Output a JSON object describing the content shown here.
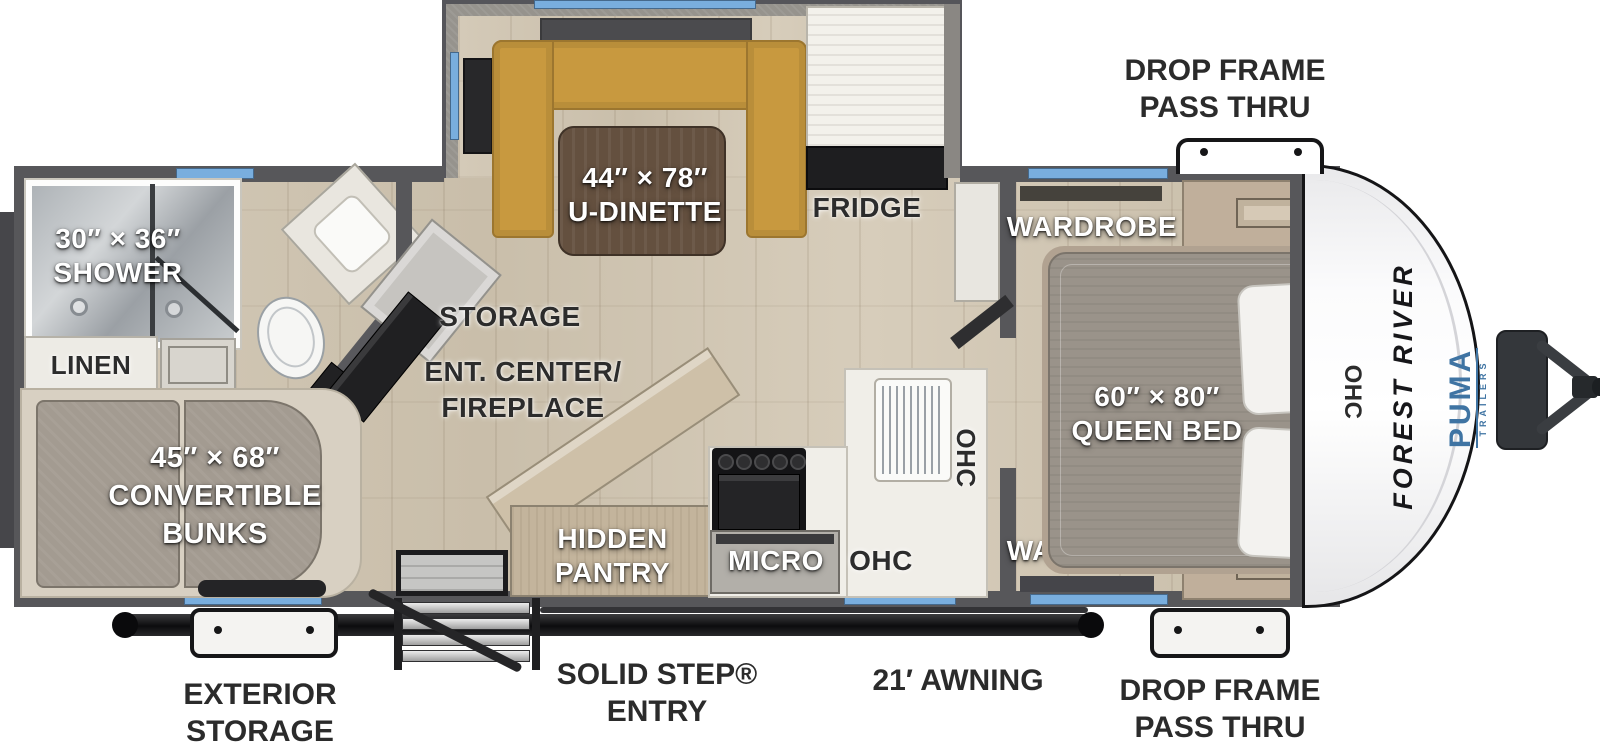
{
  "colors": {
    "window_blue": "#79aede",
    "body_wall_gray": "#57575a",
    "floor_wood": "#cfc5b2",
    "dinette_tan": "#c8993f",
    "awning_black": "#111111",
    "puma_blue": "#3f74a3",
    "label_dark": "#2b2b2b",
    "label_white": "#ffffff"
  },
  "exterior": {
    "drop_frame_top": [
      "DROP FRAME",
      "PASS THRU"
    ],
    "drop_frame_bottom": [
      "DROP FRAME",
      "PASS THRU"
    ],
    "exterior_storage": [
      "EXTERIOR",
      "STORAGE"
    ],
    "solid_step": [
      "SOLID STEP®",
      "ENTRY"
    ],
    "awning": "21′ AWNING"
  },
  "branding": {
    "make": "FOREST RIVER",
    "model": "PUMA",
    "model_sub": "TRAILERS"
  },
  "rooms": {
    "shower": {
      "size": "30″ × 36″",
      "name": "SHOWER"
    },
    "linen": "LINEN",
    "bunks": {
      "size": "45″ × 68″",
      "line2": "CONVERTIBLE",
      "line3": "BUNKS"
    },
    "storage": "STORAGE",
    "ent_center": [
      "ENT. CENTER/",
      "FIREPLACE"
    ],
    "dinette": {
      "size": "44″ × 78″",
      "name": "U-DINETTE"
    },
    "fridge": "FRIDGE",
    "hidden_pantry": [
      "HIDDEN",
      "PANTRY"
    ],
    "micro": "MICRO",
    "ohc_counter": "OHC",
    "ohc_upper": "OHC",
    "ohc_front": "OHC",
    "wardrobe_top": "WARDROBE",
    "wardrobe_bottom": "WARDROBE",
    "queen_bed": {
      "size": "60″ × 80″",
      "name": "QUEEN BED"
    }
  }
}
